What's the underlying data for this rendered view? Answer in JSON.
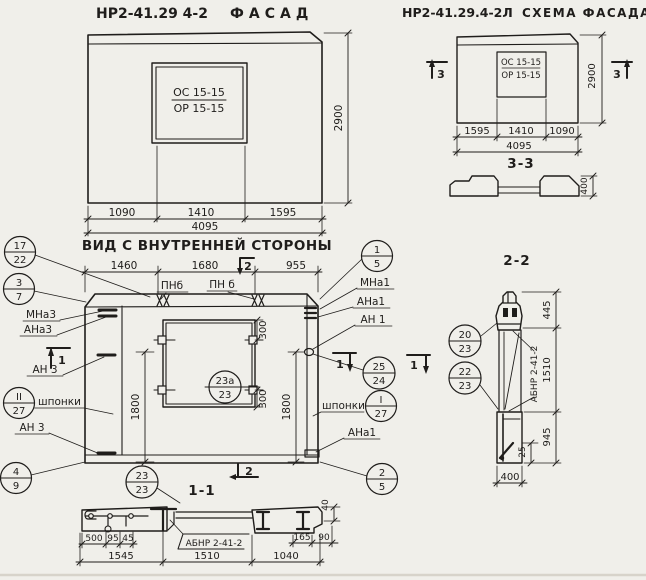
{
  "colors": {
    "paper": "#f0efea",
    "ink": "#1f1d1b"
  },
  "facade": {
    "mark": "НР2-41.29 4-2",
    "title": "ФАСАД",
    "opening_top": "ОС 15-15",
    "opening_bottom": "ОР 15-15",
    "dim_left": "1090",
    "dim_mid": "1410",
    "dim_right": "1595",
    "dim_total": "4095",
    "dim_height": "2900"
  },
  "schema": {
    "mark": "НР2-41.29.4-2Л",
    "title": "СХЕМА ФАСАДА",
    "opening_top": "ОС 15-15",
    "opening_bottom": "ОР 15-15",
    "section_mark_left": "3",
    "section_mark_right": "3",
    "dim_left": "1595",
    "dim_mid": "1410",
    "dim_right": "1090",
    "dim_total": "4095",
    "dim_height": "2900",
    "profile_title": "3-3",
    "profile_dim": "400"
  },
  "inner": {
    "title": "ВИД С ВНУТРЕННЕЙ СТОРОНЫ",
    "dim_top_left": "1460",
    "dim_top_mid": "1680",
    "dim_top_right": "955",
    "mark_top": "2",
    "mark_bottom": "2",
    "mark_section_left": "1",
    "mark_section_right_a": "1",
    "mark_section_right_b": "1",
    "label_pnb_left": "ПНб",
    "label_pnb_right": "ПН б",
    "label_mna3": "МНа3",
    "label_ana3": "АНа3",
    "label_an3_top": "АН 3",
    "label_an3_bottom": "АН 3",
    "label_shponki_left": "шпонки",
    "label_shponki_right": "шпонки",
    "label_mna1": "МНа1",
    "label_ana1": "АНа1",
    "label_an1": "АН 1",
    "label_ana1_bottom": "АНа1",
    "dim_1800_left": "1800",
    "dim_1800_right": "1800",
    "dim_300_top": "300",
    "dim_300_bottom": "300",
    "callouts": {
      "c17_22": {
        "top": "17",
        "bottom": "22"
      },
      "c3_7": {
        "top": "3",
        "bottom": "7"
      },
      "c4_9": {
        "top": "4",
        "bottom": "9"
      },
      "c1_5": {
        "top": "1",
        "bottom": "5"
      },
      "c25_24": {
        "top": "25",
        "bottom": "24"
      },
      "c2_5": {
        "top": "2",
        "bottom": "5"
      },
      "keys_left": {
        "top": "II",
        "bottom": "27"
      },
      "keys_right": {
        "top": "I",
        "bottom": "27"
      },
      "window": {
        "top": "23а",
        "bottom": "23"
      },
      "c23_23": {
        "top": "23",
        "bottom": "23"
      }
    }
  },
  "section11": {
    "title": "1-1",
    "label_abnr": "АБНР 2-41-2",
    "dim_500": "500",
    "dim_95": "95",
    "dim_45": "45",
    "dim_165": "165",
    "dim_90": "90",
    "dim_40": "40",
    "dim_1545": "1545",
    "dim_1510": "1510",
    "dim_1040": "1040"
  },
  "section22": {
    "title": "2-2",
    "label_abnr": "АБНР 2-41-2",
    "dim_445": "445",
    "dim_1510": "1510",
    "dim_945": "945",
    "dim_25": "25",
    "dim_400": "400",
    "callouts": {
      "c20_23": {
        "top": "20",
        "bottom": "23"
      },
      "c22_23": {
        "top": "22",
        "bottom": "23"
      }
    }
  }
}
